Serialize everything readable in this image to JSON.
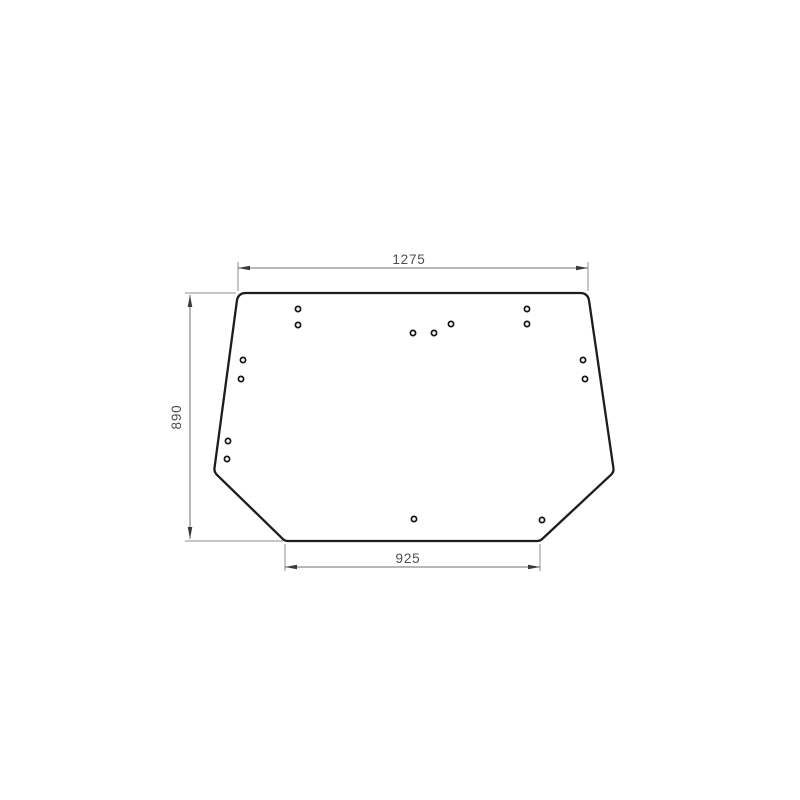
{
  "page": {
    "background": "#ffffff",
    "description": "Technical dimension drawing of a trapezoid glass panel with mounting holes"
  },
  "drawing": {
    "canvas": {
      "width": 800,
      "height": 800
    },
    "style": {
      "outline_color": "#1d1d1d",
      "outline_width": 2.3,
      "dim_line_color": "#6f6f6f",
      "dim_line_width": 1,
      "ext_line_color": "#8d8d8d",
      "ext_line_width": 1,
      "arrow_color": "#3a3a3a",
      "arrow_length": 12,
      "arrow_half_width": 2.3,
      "text_color": "#4d4d4d",
      "text_size": 13.5,
      "hole_stroke": "#141414",
      "hole_fill": "#ffffff",
      "hole_radius": 2.6,
      "hole_stroke_width": 1.7
    },
    "outline": {
      "points": [
        {
          "x": 238,
          "y": 293,
          "r": 8
        },
        {
          "x": 588,
          "y": 293,
          "r": 8
        },
        {
          "x": 614,
          "y": 472,
          "r": 4
        },
        {
          "x": 540,
          "y": 541,
          "r": 3
        },
        {
          "x": 285,
          "y": 541,
          "r": 3
        },
        {
          "x": 214,
          "y": 472,
          "r": 4
        }
      ]
    },
    "holes": [
      {
        "x": 298,
        "y": 309
      },
      {
        "x": 298,
        "y": 325
      },
      {
        "x": 413,
        "y": 333
      },
      {
        "x": 434,
        "y": 333
      },
      {
        "x": 451,
        "y": 324
      },
      {
        "x": 527,
        "y": 309
      },
      {
        "x": 527,
        "y": 324
      },
      {
        "x": 243,
        "y": 360
      },
      {
        "x": 241,
        "y": 379
      },
      {
        "x": 583,
        "y": 360
      },
      {
        "x": 585,
        "y": 379
      },
      {
        "x": 228,
        "y": 441
      },
      {
        "x": 227,
        "y": 459
      },
      {
        "x": 414,
        "y": 519
      },
      {
        "x": 542,
        "y": 520
      }
    ],
    "dimensions": [
      {
        "id": "top-width",
        "label": "1275",
        "orientation": "h",
        "line": {
          "x1": 238,
          "x2": 588,
          "y": 268
        },
        "text": {
          "x": 409,
          "y": 264
        },
        "ext": [
          {
            "x": 238,
            "y1": 262,
            "y2": 291
          },
          {
            "x": 588,
            "y1": 262,
            "y2": 291
          }
        ]
      },
      {
        "id": "left-height",
        "label": "890",
        "orientation": "v",
        "line": {
          "x": 190,
          "y1": 295,
          "y2": 539
        },
        "text": {
          "x": 181,
          "y": 417
        },
        "ext": [
          {
            "y": 293,
            "x1": 185,
            "x2": 236
          },
          {
            "y": 541,
            "x1": 185,
            "x2": 283
          }
        ]
      },
      {
        "id": "bottom-width",
        "label": "925",
        "orientation": "h",
        "line": {
          "x1": 285,
          "x2": 540,
          "y": 567
        },
        "text": {
          "x": 408,
          "y": 563
        },
        "ext": [
          {
            "x": 285,
            "y1": 544,
            "y2": 571
          },
          {
            "x": 540,
            "y1": 544,
            "y2": 571
          }
        ]
      }
    ]
  }
}
